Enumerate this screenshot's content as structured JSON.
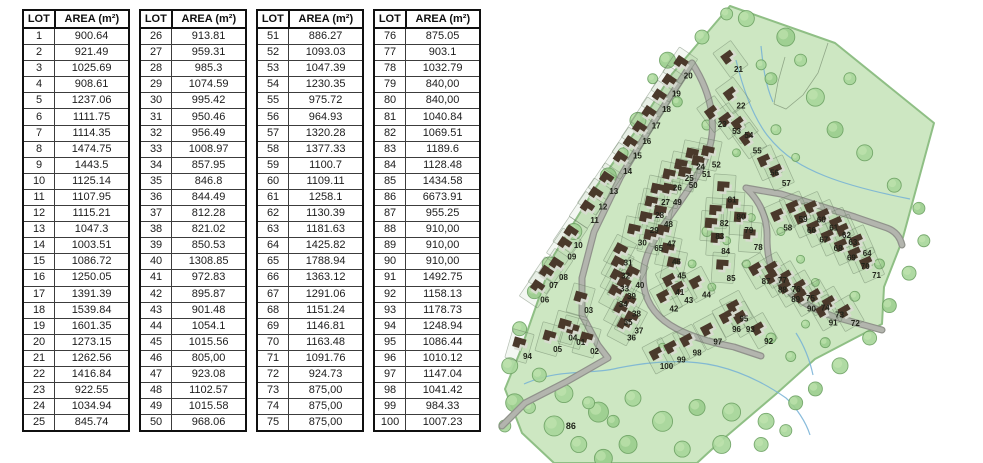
{
  "table_header": {
    "lot": "LOT",
    "area": "AREA (m²)"
  },
  "tables": [
    {
      "rows": [
        [
          "1",
          "900.64"
        ],
        [
          "2",
          "921.49"
        ],
        [
          "3",
          "1025.69"
        ],
        [
          "4",
          "908.61"
        ],
        [
          "5",
          "1237.06"
        ],
        [
          "6",
          "1111.75"
        ],
        [
          "7",
          "1114.35"
        ],
        [
          "8",
          "1474.75"
        ],
        [
          "9",
          "1443.5"
        ],
        [
          "10",
          "1125.14"
        ],
        [
          "11",
          "1107.95"
        ],
        [
          "12",
          "1115.21"
        ],
        [
          "13",
          "1047.3"
        ],
        [
          "14",
          "1003.51"
        ],
        [
          "15",
          "1086.72"
        ],
        [
          "16",
          "1250.05"
        ],
        [
          "17",
          "1391.39"
        ],
        [
          "18",
          "1539.84"
        ],
        [
          "19",
          "1601.35"
        ],
        [
          "20",
          "1273.15"
        ],
        [
          "21",
          "1262.56"
        ],
        [
          "22",
          "1416.84"
        ],
        [
          "23",
          "922.55"
        ],
        [
          "24",
          "1034.94"
        ],
        [
          "25",
          "845.74"
        ]
      ]
    },
    {
      "rows": [
        [
          "26",
          "913.81"
        ],
        [
          "27",
          "959.31"
        ],
        [
          "28",
          "985.3"
        ],
        [
          "29",
          "1074.59"
        ],
        [
          "30",
          "995.42"
        ],
        [
          "31",
          "950.46"
        ],
        [
          "32",
          "956.49"
        ],
        [
          "33",
          "1008.97"
        ],
        [
          "34",
          "857.95"
        ],
        [
          "35",
          "846.8"
        ],
        [
          "36",
          "844.49"
        ],
        [
          "37",
          "812.28"
        ],
        [
          "38",
          "821.02"
        ],
        [
          "39",
          "850.53"
        ],
        [
          "40",
          "1308.85"
        ],
        [
          "41",
          "972.83"
        ],
        [
          "42",
          "895.87"
        ],
        [
          "43",
          "901.48"
        ],
        [
          "44",
          "1054.1"
        ],
        [
          "45",
          "1015.56"
        ],
        [
          "46",
          "805,00"
        ],
        [
          "47",
          "923.08"
        ],
        [
          "48",
          "1102.57"
        ],
        [
          "49",
          "1015.58"
        ],
        [
          "50",
          "968.06"
        ]
      ]
    },
    {
      "rows": [
        [
          "51",
          "886.27"
        ],
        [
          "52",
          "1093.03"
        ],
        [
          "53",
          "1047.39"
        ],
        [
          "54",
          "1230.35"
        ],
        [
          "55",
          "975.72"
        ],
        [
          "56",
          "964.93"
        ],
        [
          "57",
          "1320.28"
        ],
        [
          "58",
          "1377.33"
        ],
        [
          "59",
          "1100.7"
        ],
        [
          "60",
          "1109.11"
        ],
        [
          "61",
          "1258.1"
        ],
        [
          "62",
          "1130.39"
        ],
        [
          "63",
          "1181.63"
        ],
        [
          "64",
          "1425.82"
        ],
        [
          "65",
          "1788.94"
        ],
        [
          "66",
          "1363.12"
        ],
        [
          "67",
          "1291.06"
        ],
        [
          "68",
          "1151.24"
        ],
        [
          "69",
          "1146.81"
        ],
        [
          "70",
          "1163.48"
        ],
        [
          "71",
          "1091.76"
        ],
        [
          "72",
          "924.73"
        ],
        [
          "73",
          "875,00"
        ],
        [
          "74",
          "875,00"
        ],
        [
          "75",
          "875,00"
        ]
      ]
    },
    {
      "rows": [
        [
          "76",
          "875.05"
        ],
        [
          "77",
          "903.1"
        ],
        [
          "78",
          "1032.79"
        ],
        [
          "79",
          "840,00"
        ],
        [
          "80",
          "840,00"
        ],
        [
          "81",
          "1040.84"
        ],
        [
          "82",
          "1069.51"
        ],
        [
          "83",
          "1189.6"
        ],
        [
          "84",
          "1128.48"
        ],
        [
          "85",
          "1434.58"
        ],
        [
          "86",
          "6673.91"
        ],
        [
          "87",
          "955.25"
        ],
        [
          "88",
          "910,00"
        ],
        [
          "89",
          "910,00"
        ],
        [
          "90",
          "910,00"
        ],
        [
          "91",
          "1492.75"
        ],
        [
          "92",
          "1158.13"
        ],
        [
          "93",
          "1178.73"
        ],
        [
          "94",
          "1248.94"
        ],
        [
          "95",
          "1086.44"
        ],
        [
          "96",
          "1010.12"
        ],
        [
          "97",
          "1147.04"
        ],
        [
          "98",
          "1041.42"
        ],
        [
          "99",
          "984.33"
        ],
        [
          "100",
          "1007.23"
        ]
      ]
    }
  ],
  "map": {
    "colors": {
      "land": "#cde7c2",
      "land_edge": "#8fbf85",
      "road": "#b3b5ae",
      "road_edge": "#90928b",
      "tree": "#a9d79c",
      "tree_edge": "#6da263",
      "house": "#4a392b",
      "house_shadow": "#d9dbd3",
      "stream": "#74b0d6",
      "parcel_line": "#5f7358",
      "label": "#20241a"
    },
    "no_house_lots": [
      "86"
    ],
    "lots": [
      {
        "n": "01",
        "x": 17.8,
        "y": 73.9
      },
      {
        "n": "02",
        "x": 20.6,
        "y": 75.8
      },
      {
        "n": "03",
        "x": 19.4,
        "y": 67.0
      },
      {
        "n": "04",
        "x": 16.2,
        "y": 72.9
      },
      {
        "n": "05",
        "x": 13.1,
        "y": 75.4
      },
      {
        "n": "06",
        "x": 10.5,
        "y": 64.7
      },
      {
        "n": "07",
        "x": 12.3,
        "y": 61.6
      },
      {
        "n": "08",
        "x": 14.3,
        "y": 59.8
      },
      {
        "n": "09",
        "x": 16.0,
        "y": 55.4
      },
      {
        "n": "10",
        "x": 17.3,
        "y": 52.9
      },
      {
        "n": "11",
        "x": 20.6,
        "y": 47.5
      },
      {
        "n": "12",
        "x": 22.3,
        "y": 44.6
      },
      {
        "n": "13",
        "x": 24.5,
        "y": 41.3
      },
      {
        "n": "14",
        "x": 27.3,
        "y": 36.9
      },
      {
        "n": "15",
        "x": 29.3,
        "y": 33.6
      },
      {
        "n": "16",
        "x": 31.2,
        "y": 30.4
      },
      {
        "n": "17",
        "x": 33.1,
        "y": 27.1
      },
      {
        "n": "18",
        "x": 35.2,
        "y": 23.5
      },
      {
        "n": "19",
        "x": 37.2,
        "y": 20.2
      },
      {
        "n": "20",
        "x": 39.6,
        "y": 16.3
      },
      {
        "n": "21",
        "x": 49.8,
        "y": 14.9
      },
      {
        "n": "22",
        "x": 50.3,
        "y": 22.8
      },
      {
        "n": "23",
        "x": 46.5,
        "y": 26.8
      },
      {
        "n": "24",
        "x": 42.1,
        "y": 36.0
      },
      {
        "n": "25",
        "x": 39.8,
        "y": 38.4
      },
      {
        "n": "26",
        "x": 37.4,
        "y": 40.5
      },
      {
        "n": "27",
        "x": 35.0,
        "y": 43.6
      },
      {
        "n": "28",
        "x": 33.8,
        "y": 46.4
      },
      {
        "n": "29",
        "x": 32.7,
        "y": 49.7
      },
      {
        "n": "30",
        "x": 30.3,
        "y": 52.4
      },
      {
        "n": "31",
        "x": 27.4,
        "y": 56.7
      },
      {
        "n": "32",
        "x": 26.9,
        "y": 59.5
      },
      {
        "n": "33",
        "x": 26.7,
        "y": 62.3
      },
      {
        "n": "34",
        "x": 26.4,
        "y": 65.7
      },
      {
        "n": "35",
        "x": 27.4,
        "y": 69.5
      },
      {
        "n": "36",
        "x": 28.1,
        "y": 72.9
      },
      {
        "n": "37",
        "x": 29.6,
        "y": 71.4
      },
      {
        "n": "38",
        "x": 29.1,
        "y": 67.7
      },
      {
        "n": "39",
        "x": 28.1,
        "y": 63.9
      },
      {
        "n": "40",
        "x": 29.8,
        "y": 61.6
      },
      {
        "n": "41",
        "x": 37.9,
        "y": 63.1
      },
      {
        "n": "42",
        "x": 36.7,
        "y": 66.6
      },
      {
        "n": "43",
        "x": 39.7,
        "y": 64.8
      },
      {
        "n": "44",
        "x": 43.3,
        "y": 63.6
      },
      {
        "n": "45",
        "x": 38.3,
        "y": 59.5
      },
      {
        "n": "46",
        "x": 37.2,
        "y": 56.5
      },
      {
        "n": "47",
        "x": 36.2,
        "y": 52.6
      },
      {
        "n": "48",
        "x": 35.6,
        "y": 48.4
      },
      {
        "n": "49",
        "x": 37.4,
        "y": 43.6
      },
      {
        "n": "50",
        "x": 40.6,
        "y": 40.0
      },
      {
        "n": "51",
        "x": 43.3,
        "y": 37.6
      },
      {
        "n": "52",
        "x": 45.3,
        "y": 35.5
      },
      {
        "n": "53",
        "x": 49.4,
        "y": 28.3
      },
      {
        "n": "54",
        "x": 51.9,
        "y": 29.2
      },
      {
        "n": "55",
        "x": 53.6,
        "y": 32.5
      },
      {
        "n": "56",
        "x": 57.1,
        "y": 37.3
      },
      {
        "n": "57",
        "x": 59.5,
        "y": 39.5
      },
      {
        "n": "58",
        "x": 59.8,
        "y": 49.1
      },
      {
        "n": "59",
        "x": 62.9,
        "y": 47.3
      },
      {
        "n": "60",
        "x": 66.6,
        "y": 47.4
      },
      {
        "n": "61",
        "x": 69.1,
        "y": 49.1
      },
      {
        "n": "62",
        "x": 71.7,
        "y": 50.8
      },
      {
        "n": "63",
        "x": 73.0,
        "y": 52.3
      },
      {
        "n": "64",
        "x": 75.9,
        "y": 54.6
      },
      {
        "n": "65",
        "x": 33.6,
        "y": 53.6
      },
      {
        "n": "66",
        "x": 64.6,
        "y": 49.7
      },
      {
        "n": "67",
        "x": 67.1,
        "y": 51.7
      },
      {
        "n": "68",
        "x": 70.0,
        "y": 53.6
      },
      {
        "n": "69",
        "x": 72.7,
        "y": 55.6
      },
      {
        "n": "70",
        "x": 75.5,
        "y": 57.4
      },
      {
        "n": "71",
        "x": 77.8,
        "y": 59.4
      },
      {
        "n": "72",
        "x": 73.5,
        "y": 69.8
      },
      {
        "n": "73",
        "x": 70.3,
        "y": 67.9
      },
      {
        "n": "74",
        "x": 67.4,
        "y": 66.4
      },
      {
        "n": "75",
        "x": 64.4,
        "y": 64.4
      },
      {
        "n": "76",
        "x": 61.5,
        "y": 62.4
      },
      {
        "n": "77",
        "x": 58.7,
        "y": 60.5
      },
      {
        "n": "78",
        "x": 53.8,
        "y": 53.4
      },
      {
        "n": "79",
        "x": 51.9,
        "y": 49.7
      },
      {
        "n": "80",
        "x": 50.3,
        "y": 46.8
      },
      {
        "n": "81",
        "x": 48.5,
        "y": 43.1
      },
      {
        "n": "82",
        "x": 46.9,
        "y": 48.2
      },
      {
        "n": "83",
        "x": 46.0,
        "y": 51.0
      },
      {
        "n": "84",
        "x": 47.2,
        "y": 54.2
      },
      {
        "n": "85",
        "x": 48.3,
        "y": 60.0
      },
      {
        "n": "86",
        "x": 15.8,
        "y": 92.0
      },
      {
        "n": "87",
        "x": 55.4,
        "y": 60.7
      },
      {
        "n": "88",
        "x": 58.7,
        "y": 62.5
      },
      {
        "n": "89",
        "x": 61.4,
        "y": 64.6
      },
      {
        "n": "90",
        "x": 64.6,
        "y": 66.6
      },
      {
        "n": "91",
        "x": 69.0,
        "y": 69.7
      },
      {
        "n": "92",
        "x": 55.9,
        "y": 73.6
      },
      {
        "n": "93",
        "x": 52.2,
        "y": 71.1
      },
      {
        "n": "94",
        "x": 7.0,
        "y": 76.9
      },
      {
        "n": "95",
        "x": 50.9,
        "y": 68.8
      },
      {
        "n": "96",
        "x": 49.4,
        "y": 71.1
      },
      {
        "n": "97",
        "x": 45.6,
        "y": 73.8
      },
      {
        "n": "98",
        "x": 41.4,
        "y": 76.1
      },
      {
        "n": "99",
        "x": 38.2,
        "y": 77.6
      },
      {
        "n": "100",
        "x": 35.2,
        "y": 79.0
      }
    ]
  }
}
